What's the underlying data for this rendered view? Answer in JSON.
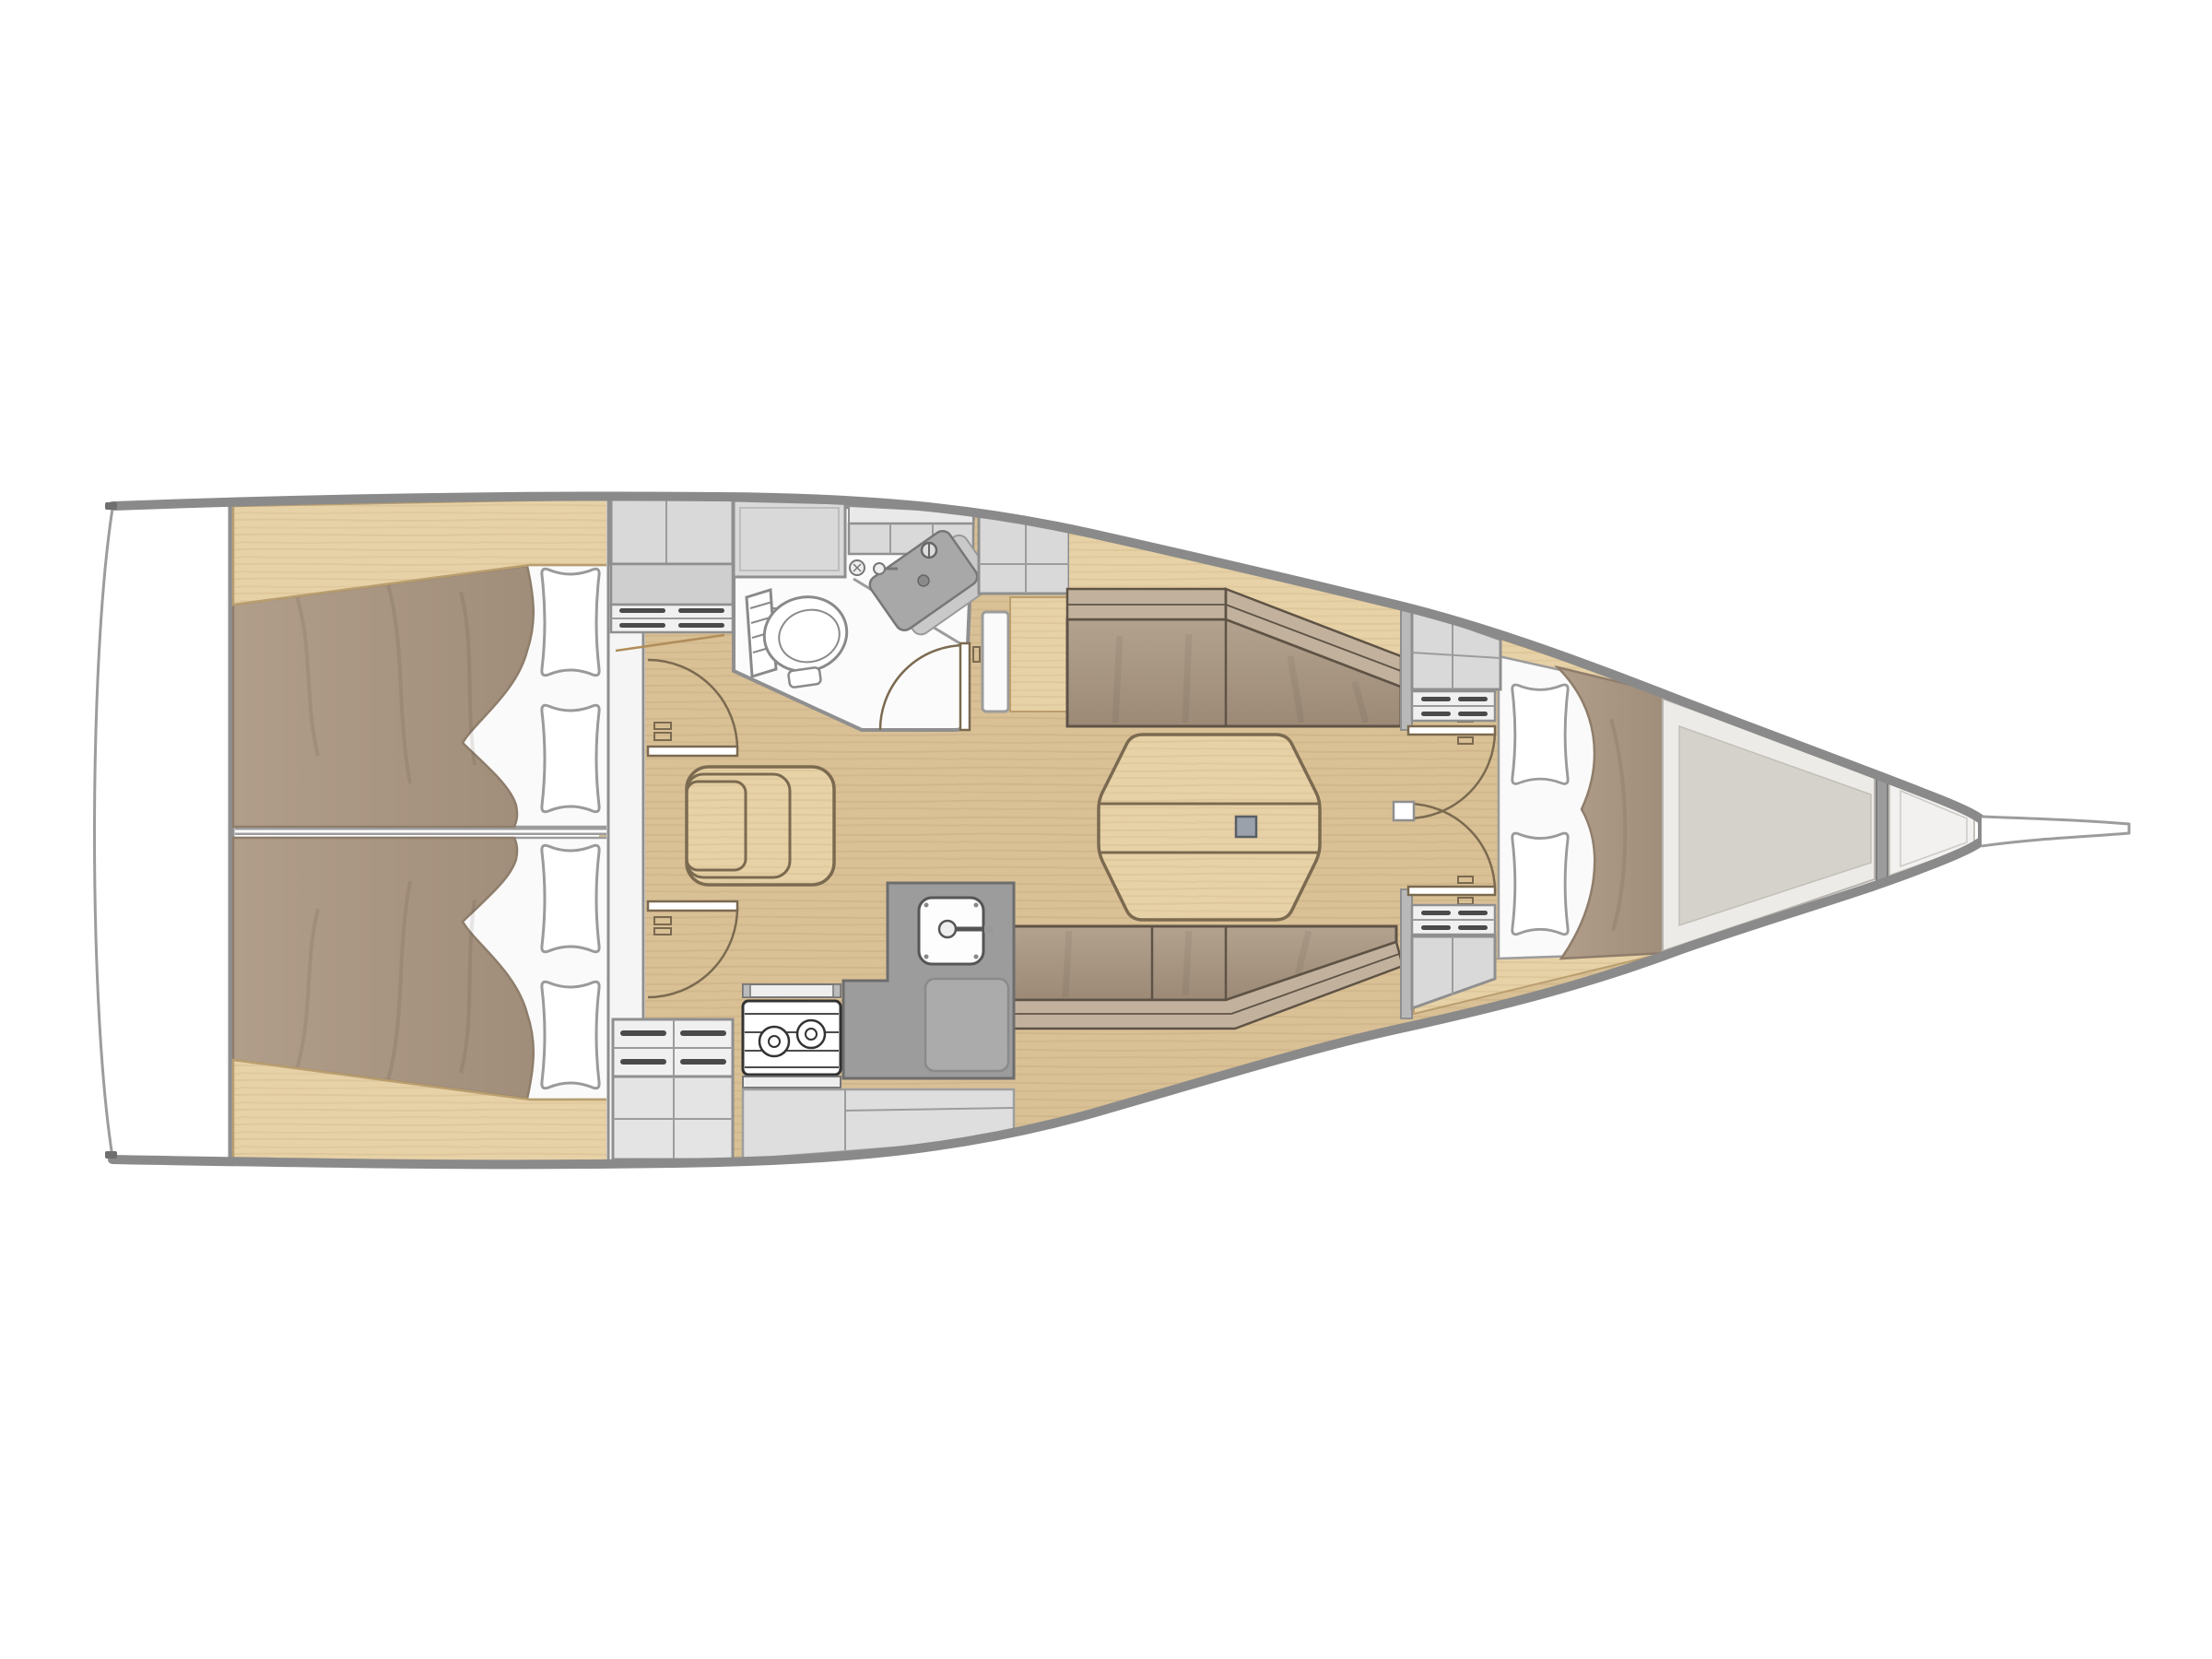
{
  "diagram": {
    "type": "sailboat-interior-floor-plan",
    "orientation": "bow-right",
    "rooms": [
      {
        "name": "swim-platform"
      },
      {
        "name": "aft-cabin-port"
      },
      {
        "name": "aft-cabin-starboard"
      },
      {
        "name": "companionway"
      },
      {
        "name": "head"
      },
      {
        "name": "saloon"
      },
      {
        "name": "galley"
      },
      {
        "name": "forward-cabin"
      },
      {
        "name": "chain-locker"
      },
      {
        "name": "bowsprit"
      }
    ],
    "furniture": [
      "aft-double-berth-port",
      "aft-double-berth-starboard",
      "pillows",
      "companionway-steps",
      "cabin-doors",
      "toilet",
      "washbasin",
      "overhead-lockers",
      "saloon-table",
      "folding-table-leaf",
      "settee-port",
      "settee-starboard",
      "galley-sink",
      "two-burner-stove",
      "worktop",
      "drawers",
      "v-berth",
      "forward-lockers",
      "collision-bulkhead"
    ]
  },
  "colors": {
    "white": "#ffffff",
    "hull_outline": "#8a8a8a",
    "thin_line": "#9c9c9c",
    "wood_floor": "#d9c095",
    "wood_light": "#e7d1a6",
    "wood_edge": "#b99e6f",
    "door_line": "#7b6a50",
    "mattress_light": "#b19e8a",
    "mattress": "#a08d7a",
    "mattress_dark": "#8f7d6b",
    "sheet_white": "#fafafa",
    "cushion_seat_top": "#b3a28e",
    "cushion_seat_bottom": "#9c8a77",
    "cushion_back": "#c2b29d",
    "cushion_edge": "#5f5346",
    "locker_gray": "#d9d9d9",
    "locker_gray_dark": "#cfcfcf",
    "drawer_face": "#f0f0f0",
    "slot_dark": "#4a4a4a",
    "counter_dark": "#9c9c9c",
    "counter_mid": "#ababab",
    "cabinet_light": "#dedede",
    "bow_gray": "#d5d2cc",
    "bow_band": "#edebe7",
    "table_leg": "#9aa1ab"
  }
}
